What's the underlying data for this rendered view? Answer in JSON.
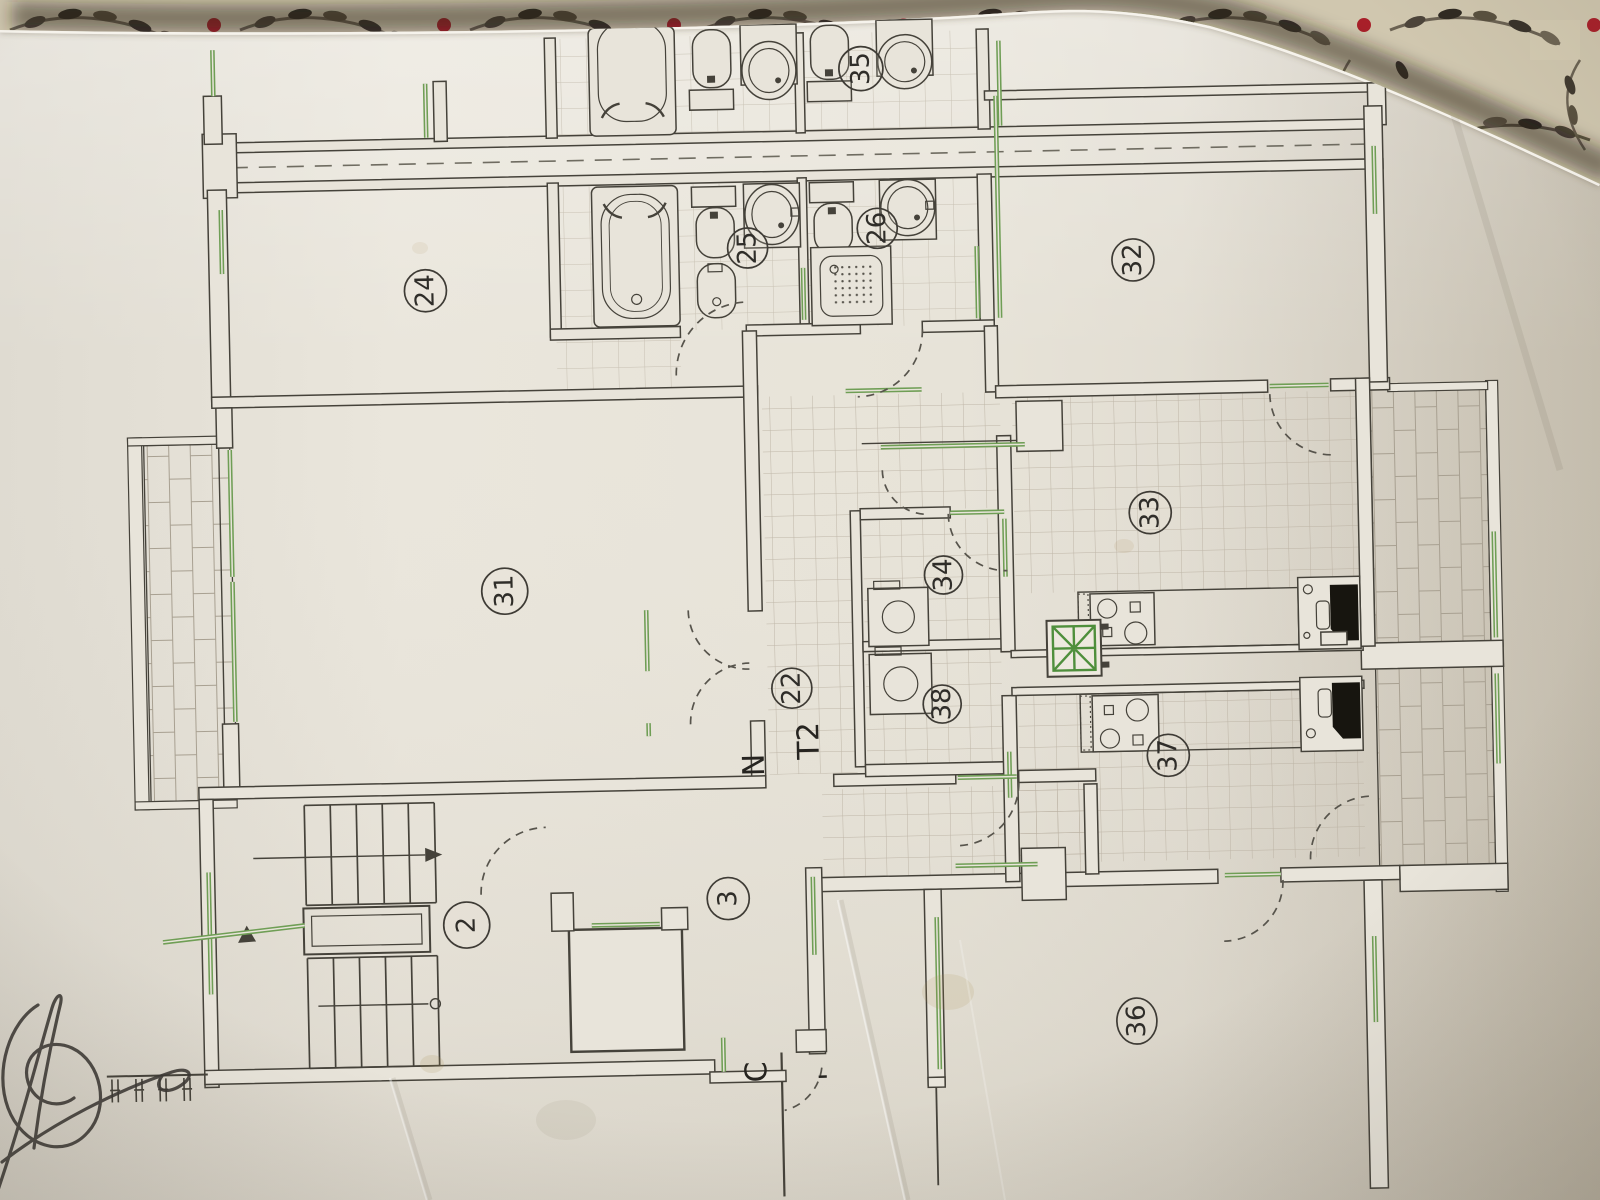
{
  "plan": {
    "labels": {
      "r2": "2",
      "r3": "3",
      "r22": "22",
      "r24": "24",
      "r25": "25",
      "r26": "26",
      "r31": "31",
      "r32": "32",
      "r33": "33",
      "r34": "34",
      "r35_partial": "35",
      "r36": "36",
      "r37": "37",
      "r38": "38",
      "unit_type": "T2",
      "unit_letter": "N",
      "stair_core": "C",
      "tick_mark": "'"
    }
  },
  "colors": {
    "paper": "#e8e4da",
    "wall_line": "#45423a",
    "window_green": "#6f9e55",
    "fabric_base": "#cfc6ae",
    "fabric_berry": "#b0222b",
    "tile_line": "#b7ae9f"
  }
}
